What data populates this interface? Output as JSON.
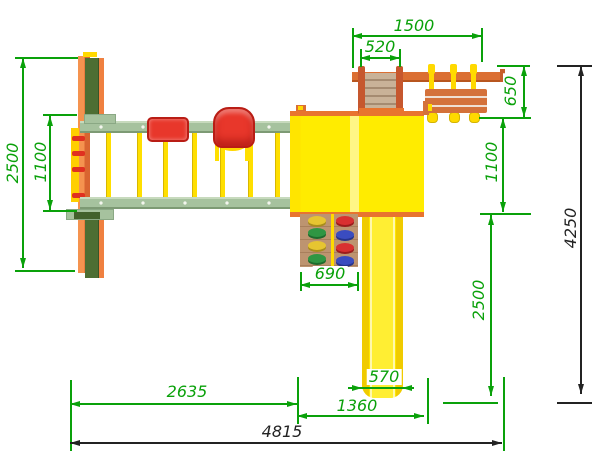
{
  "drawing": {
    "title": "playground-top-view",
    "dims": {
      "frame_depth_left": "2500",
      "beam_gap_left": "1100",
      "top_module_span": "1500",
      "ramp_width": "520",
      "net_depth_right": "650",
      "tower_depth_right": "1100",
      "slide_run_right": "2500",
      "wall_width": "690",
      "swing_length": "2635",
      "tower_span": "1360",
      "slide_width": "570",
      "total_width": "4815",
      "total_depth": "4250"
    },
    "colors": {
      "dimension_green": "#0aa10a",
      "dimension_black": "#232323",
      "beam_green": "#a6c29e",
      "frame_leg_green": "#4d6e33",
      "frame_orange": "#ef7f3f",
      "wood_beam_orange": "#db6f33",
      "roof_yellow": "#ffec00",
      "rope_yellow": "#ffd900",
      "seat_red": "#e8372b",
      "wall_brown": "#ba8f69",
      "hold_colors": [
        "#e6c531",
        "#2f9643",
        "#d93030",
        "#3a4cc0"
      ]
    }
  }
}
